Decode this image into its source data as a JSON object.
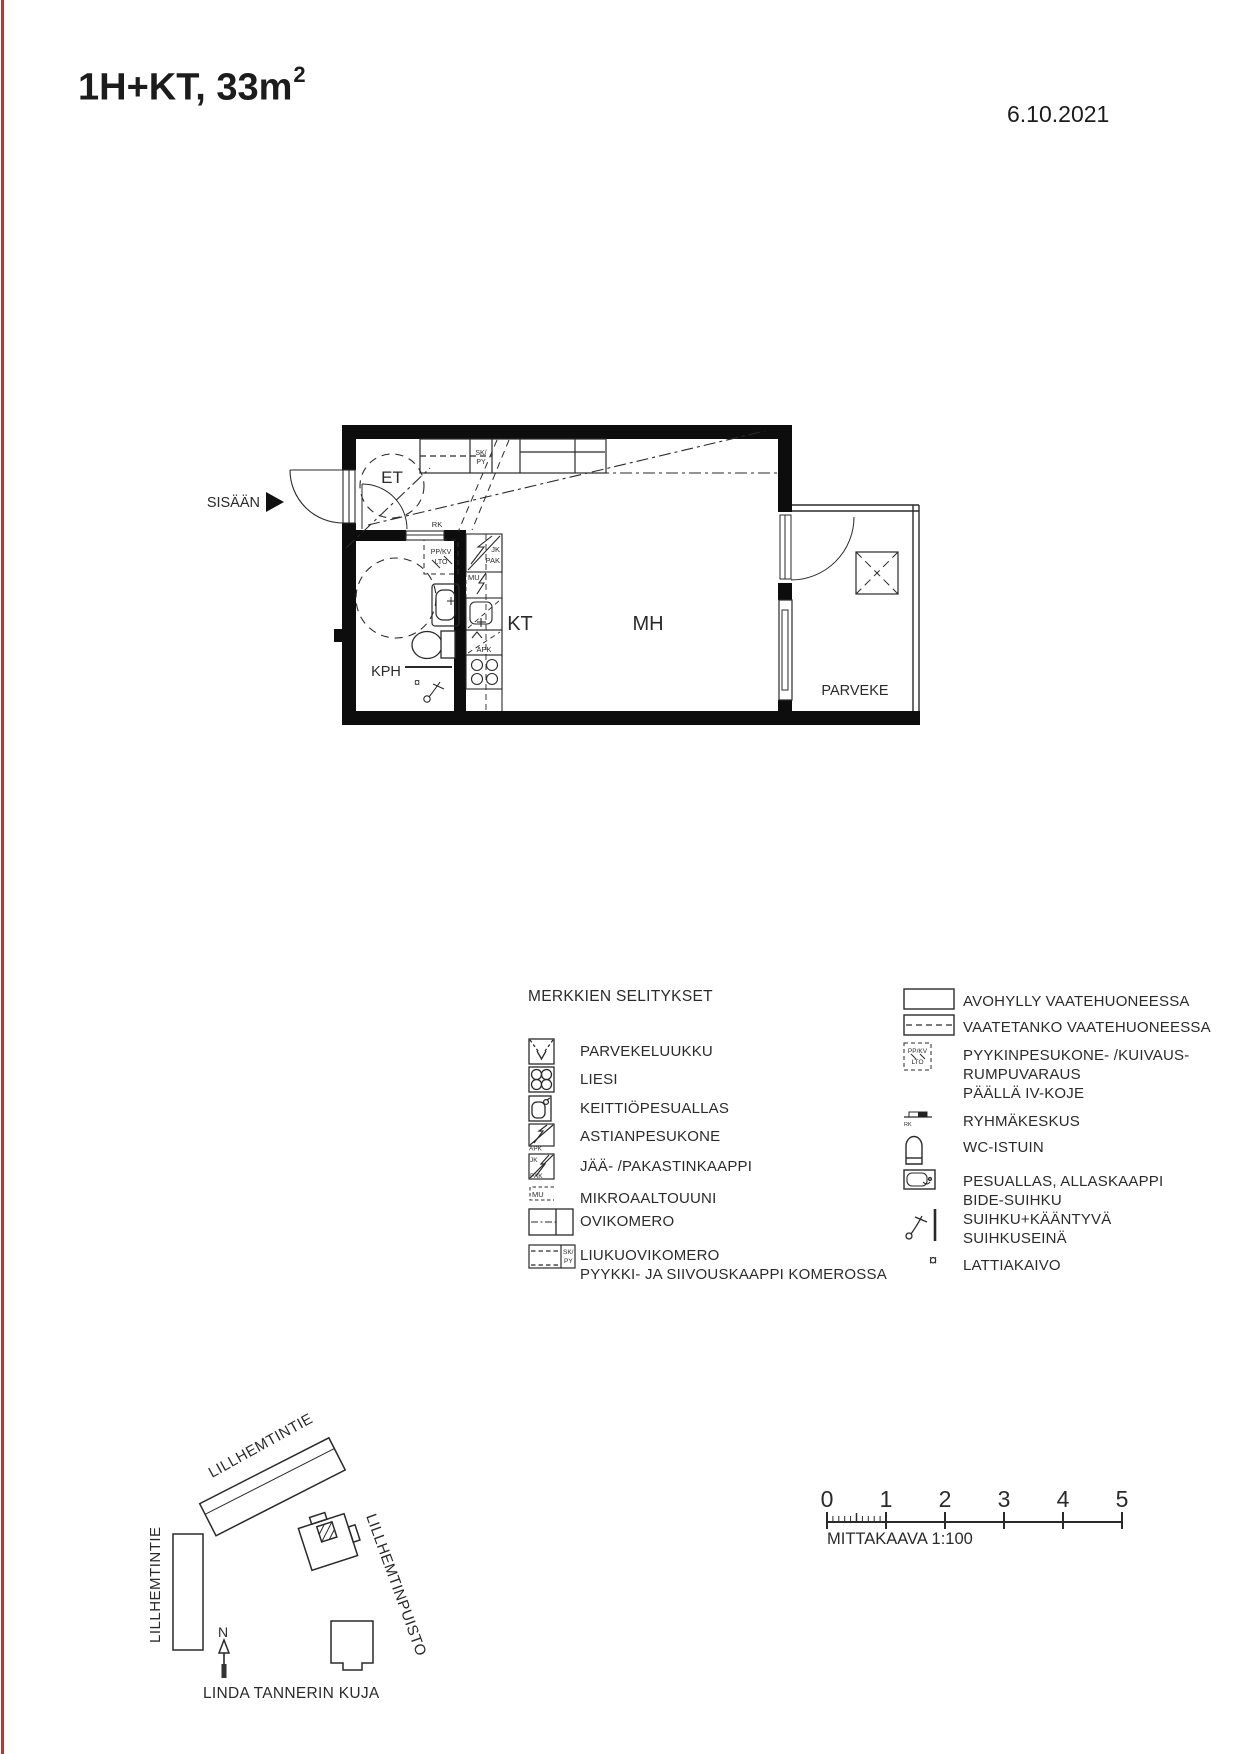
{
  "page": {
    "background": "#ffffff",
    "edge_line_color": "#b03a36",
    "ink": "#1c1c1c"
  },
  "header": {
    "title_main": "1H+KT, 33m",
    "title_sup": "2",
    "date": "6.10.2021"
  },
  "plan": {
    "entrance_label": "SISÄÄN",
    "rooms": {
      "et": "ET",
      "kph": "KPH",
      "kt": "KT",
      "mh": "MH",
      "parveke": "PARVEKE"
    },
    "tags": {
      "sk": "SK/",
      "py": "PY",
      "rk": "RK",
      "ppkv": "PP/KV",
      "lto": "LTO",
      "jk": "JK",
      "pak": "PAK",
      "mu": "MU",
      "apk": "APK",
      "drain": "¤"
    }
  },
  "legend": {
    "heading": "MERKKIEN SELITYKSET",
    "left": [
      {
        "label": "PARVEKELUUKKU"
      },
      {
        "label": "LIESI"
      },
      {
        "label": "KEITTIÖPESUALLAS"
      },
      {
        "label": "ASTIANPESUKONE"
      },
      {
        "label": "JÄÄ- /PAKASTINKAAPPI"
      },
      {
        "label": "MIKROAALTOUUNI"
      },
      {
        "label": "OVIKOMERO"
      },
      {
        "label": "LIUKUOVIKOMERO",
        "label2": "PYYKKI- JA SIIVOUSKAAPPI KOMEROSSA"
      }
    ],
    "right": [
      {
        "label": "AVOHYLLY VAATEHUONEESSA"
      },
      {
        "label": "VAATETANKO VAATEHUONEESSA"
      },
      {
        "label": "PYYKINPESUKONE- /KUIVAUS-",
        "label2": "RUMPUVARAUS",
        "label3": "PÄÄLLÄ IV-KOJE"
      },
      {
        "label": "RYHMÄKESKUS"
      },
      {
        "label": "WC-ISTUIN"
      },
      {
        "label": "PESUALLAS, ALLASKAAPPI",
        "label2": "BIDE-SUIHKU"
      },
      {
        "label": "SUIHKU+KÄÄNTYVÄ",
        "label2": "SUIHKUSEINÄ"
      },
      {
        "label": "LATTIAKAIVO",
        "symbol": "¤"
      }
    ],
    "icon_tags": {
      "apk": "APK",
      "jk": "JK",
      "pak": "PAK",
      "mu": "MU",
      "sk": "SK/",
      "py": "PY",
      "ppkv": "PP/KV",
      "lto": "LTO",
      "rk": "RK"
    }
  },
  "site_map": {
    "street_top": "LILLHEMTINTIE",
    "street_left": "LILLHEMTINTIE",
    "park": "LILLHEMTINPUISTO",
    "street_bottom": "LINDA TANNERIN KUJA",
    "north": "N"
  },
  "scale_bar": {
    "ticks": [
      "0",
      "1",
      "2",
      "3",
      "4",
      "5"
    ],
    "caption": "MITTAKAAVA 1:100"
  }
}
